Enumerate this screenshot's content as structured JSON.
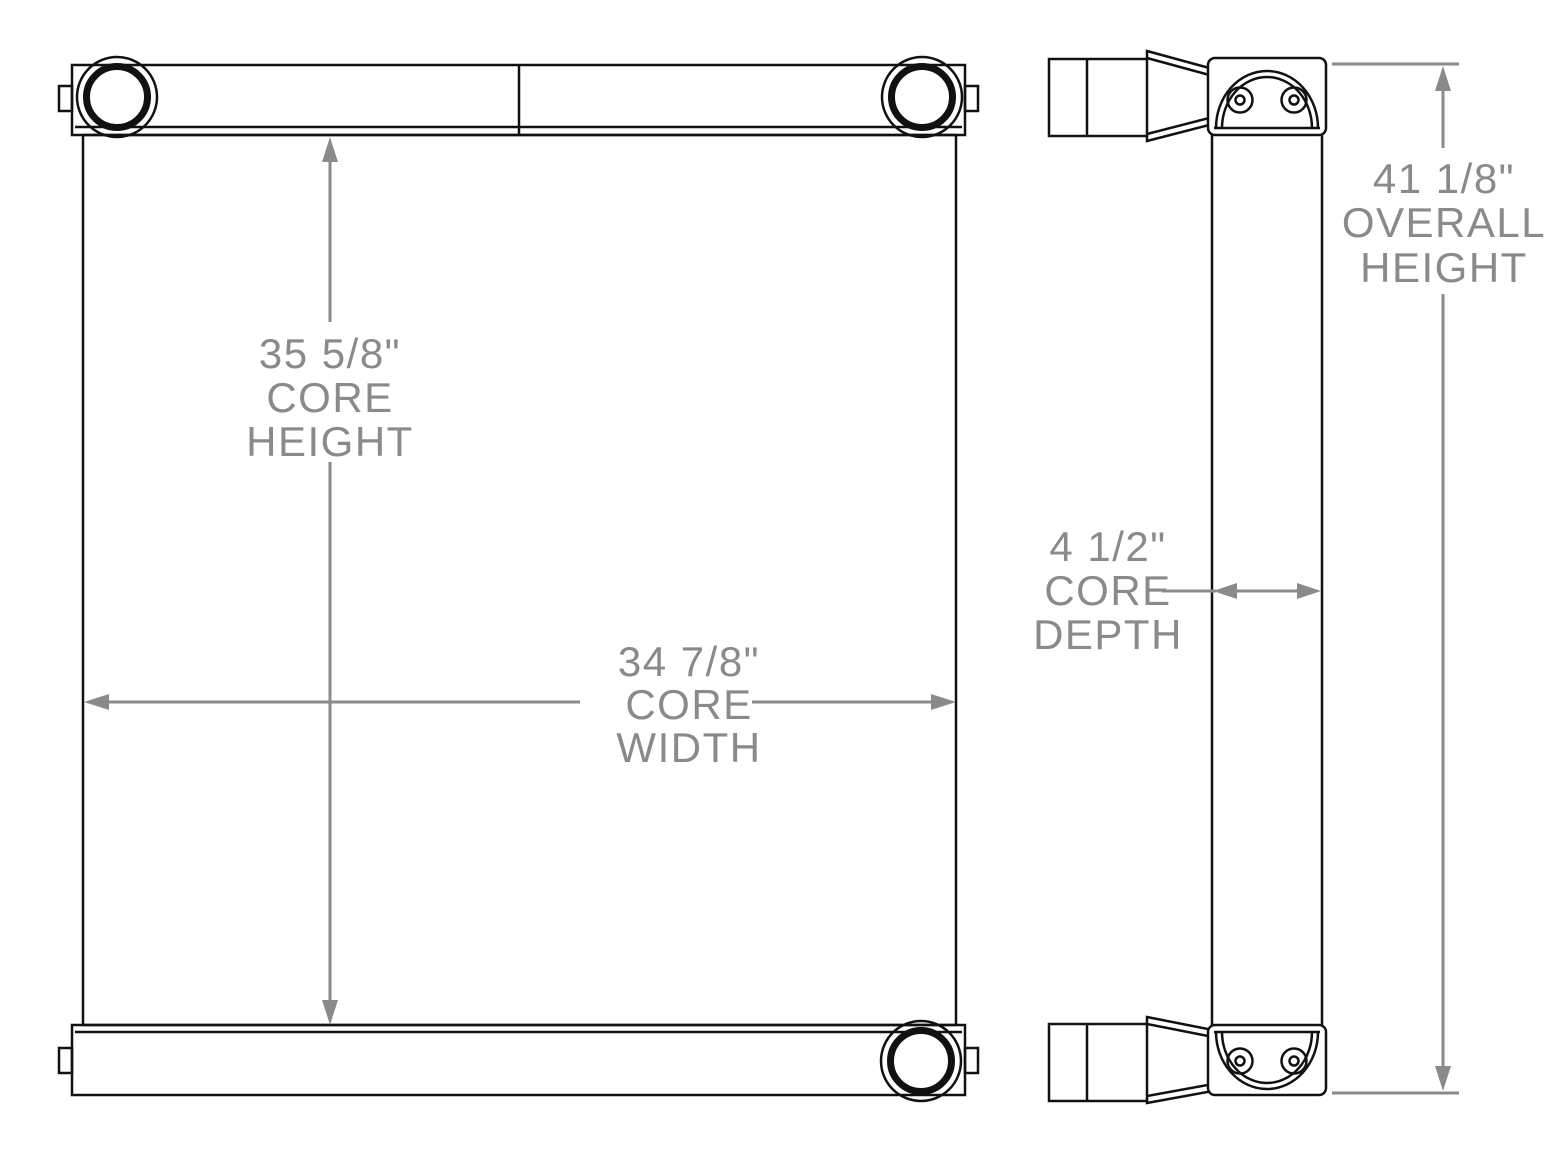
{
  "colors": {
    "background": "#ffffff",
    "part-line": "#111111",
    "dimension": "#8a8a8a"
  },
  "dimensions": {
    "core_height": {
      "value": "35 5/8\"",
      "label1": "CORE",
      "label2": "HEIGHT"
    },
    "core_width": {
      "value": "34 7/8\"",
      "label1": "CORE",
      "label2": "WIDTH"
    },
    "core_depth": {
      "value": "4 1/2\"",
      "label1": "CORE",
      "label2": "DEPTH"
    },
    "overall_height": {
      "value": "41 1/8\"",
      "label1": "OVERALL",
      "label2": "HEIGHT"
    }
  }
}
